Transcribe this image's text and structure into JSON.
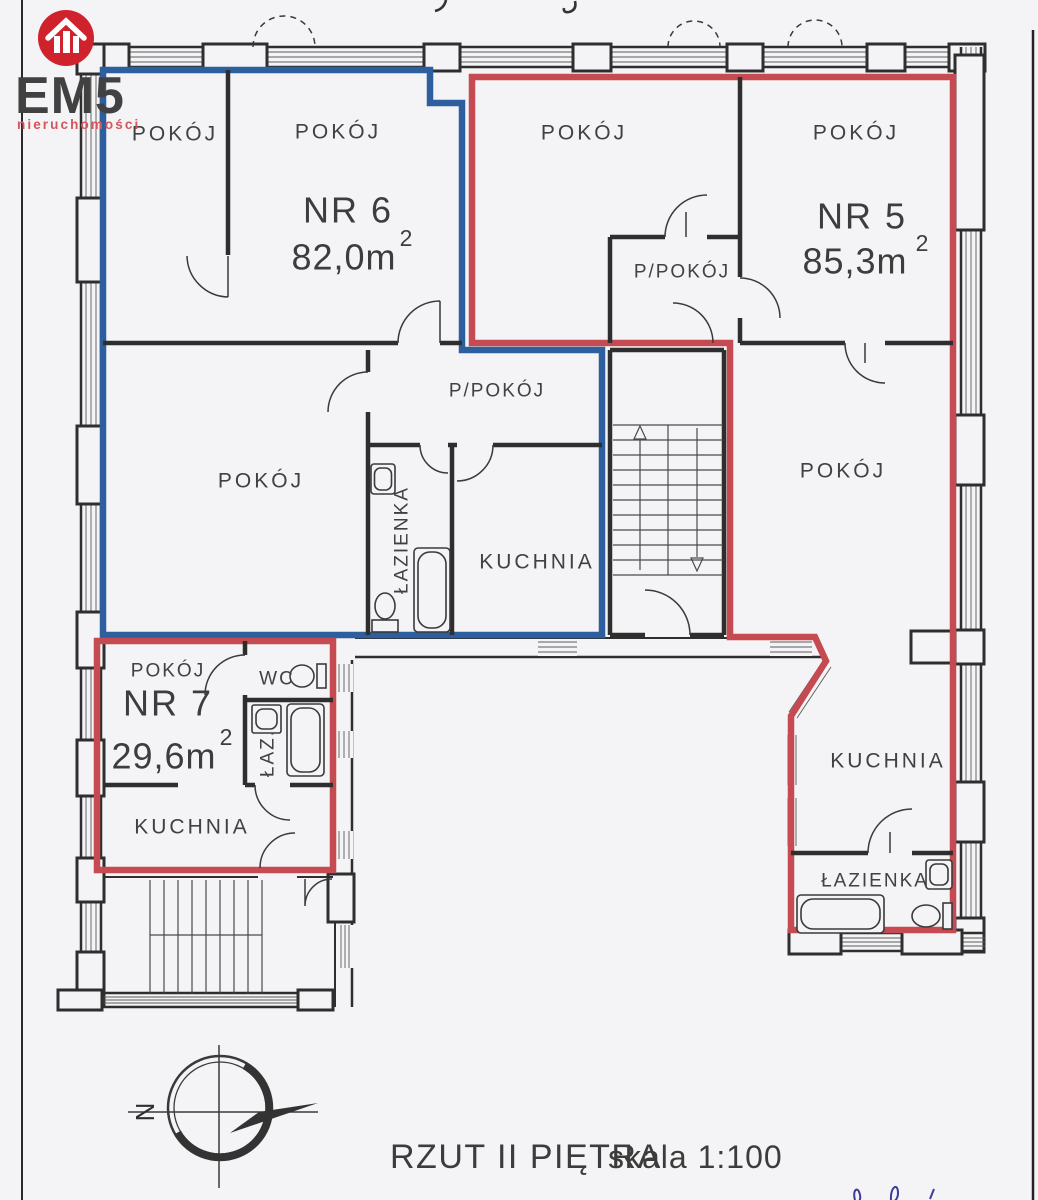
{
  "logo": {
    "brand": "EM5",
    "tagline": "nieruchomości"
  },
  "plan": {
    "apt6": {
      "id": "NR 6",
      "area": "82,0m",
      "area_sup": "2",
      "room_top_left": "POKÓJ",
      "room_top_right": "POKÓJ",
      "room_main": "POKÓJ",
      "hall": "P/POKÓJ",
      "bath": "ŁAZIENKA",
      "kitchen": "KUCHNIA"
    },
    "apt5": {
      "id": "NR 5",
      "area": "85,3m",
      "area_sup": "2",
      "room_top_left": "POKÓJ",
      "room_top_right": "POKÓJ",
      "hall": "P/POKÓJ",
      "room_lower": "POKÓJ",
      "kitchen": "KUCHNIA",
      "bath": "ŁAZIENKA"
    },
    "apt7": {
      "id": "NR 7",
      "area": "29,6m",
      "area_sup": "2",
      "room": "POKÓJ",
      "wc": "WC",
      "bath": "ŁAZ.",
      "kitchen": "KUCHNIA"
    }
  },
  "compass": {
    "north": "N"
  },
  "caption": {
    "title": "RZUT II PIĘTRA",
    "scale": "skala 1:100"
  },
  "colors": {
    "apt6_outline": "#2d5f9e",
    "apt5_outline": "#c54a51",
    "apt7_outline": "#c54a51",
    "wall": "#2e2e2e",
    "logo_red": "#d0222d",
    "paper": "#f4f4f6",
    "signature_ink": "#3c3c96"
  }
}
